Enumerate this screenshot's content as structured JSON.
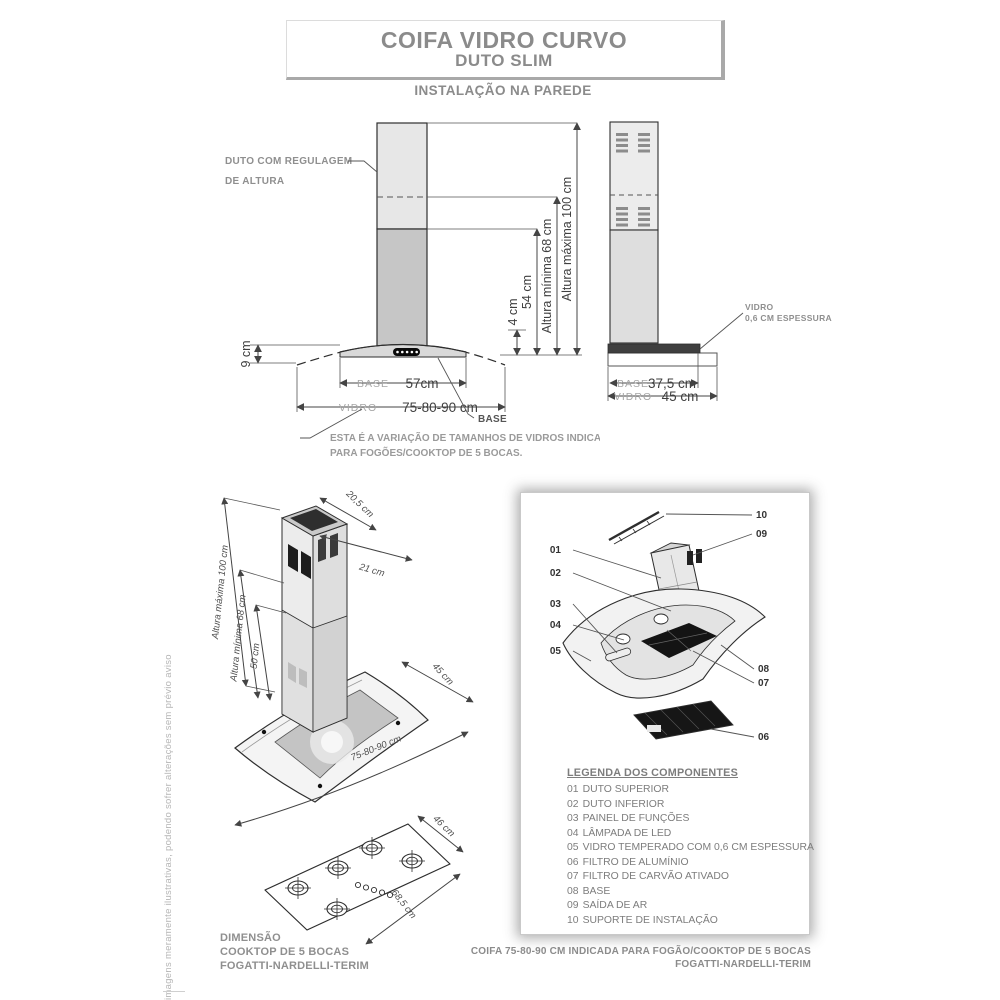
{
  "page": {
    "title_line1": "COIFA VIDRO CURVO",
    "title_line2": "DUTO SLIM",
    "subtitle": "INSTALAÇÃO NA PAREDE",
    "side_note": "imagens meramente ilustrativas, podendo sofrer alterações sem prévio aviso",
    "footer_line1": "COIFA 75-80-90 CM INDICADA PARA FOGÃO/COOKTOP DE 5 BOCAS",
    "footer_line2": "FOGATTI-NARDELLI-TERIM"
  },
  "colors": {
    "text_gray": "#8b8b8b",
    "dim_dark": "#3f3f3f",
    "duct_upper": "#e7e7e7",
    "duct_lower": "#c6c6c6"
  },
  "front_view": {
    "duct_label_line1": "DUTO COM REGULAGEM",
    "duct_label_line2": "DE ALTURA",
    "dim_altura_maxima": "Altura máxima 100 cm",
    "dim_altura_minima": "Altura mínima 68 cm",
    "dim_54": "54 cm",
    "dim_4": "4 cm",
    "dim_9": "9 cm",
    "base_word": "BASE",
    "base_value": "57cm",
    "vidro_word": "VIDRO",
    "vidro_value": "75-80-90 cm",
    "base_callout": "BASE",
    "note_line1": "ESTA É A VARIAÇÃO DE TAMANHOS DE VIDROS INDICADOS",
    "note_line2": "PARA FOGÕES/COOKTOP DE 5 BOCAS."
  },
  "side_view": {
    "glass_label_line1": "VIDRO",
    "glass_label_line2": "0,6 CM ESPESSURA",
    "base_word": "BASE",
    "base_value": "37,5 cm",
    "vidro_word": "VIDRO",
    "vidro_value": "45 cm"
  },
  "iso_view": {
    "dim_depth_top": "20,5 cm",
    "dim_width_top": "21 cm",
    "dim_altura_maxima": "Altura máxima 100 cm",
    "dim_altura_minima": "Altura mínima 68 cm",
    "dim_50": "50 cm",
    "dim_45": "45 cm",
    "dim_glass": "75-80-90 cm"
  },
  "cooktop": {
    "dim_depth": "46 cm",
    "dim_width": "68,5 cm",
    "caption_line1": "DIMENSÃO",
    "caption_line2": "COOKTOP DE 5 BOCAS",
    "caption_line3": "FOGATTI-NARDELLI-TERIM"
  },
  "exploded": {
    "callouts": [
      "01",
      "02",
      "03",
      "04",
      "05",
      "06",
      "07",
      "08",
      "09",
      "10"
    ],
    "legend_title": "LEGENDA DOS COMPONENTES",
    "legend_items": [
      {
        "num": "01",
        "label": "DUTO SUPERIOR"
      },
      {
        "num": "02",
        "label": "DUTO INFERIOR"
      },
      {
        "num": "03",
        "label": "PAINEL DE FUNÇÕES"
      },
      {
        "num": "04",
        "label": "LÂMPADA DE LED"
      },
      {
        "num": "05",
        "label": "VIDRO TEMPERADO COM 0,6 CM ESPESSURA"
      },
      {
        "num": "06",
        "label": "FILTRO DE ALUMÍNIO"
      },
      {
        "num": "07",
        "label": "FILTRO DE CARVÃO ATIVADO"
      },
      {
        "num": "08",
        "label": "BASE"
      },
      {
        "num": "09",
        "label": "SAÍDA DE AR"
      },
      {
        "num": "10",
        "label": "SUPORTE DE INSTALAÇÃO"
      }
    ]
  }
}
